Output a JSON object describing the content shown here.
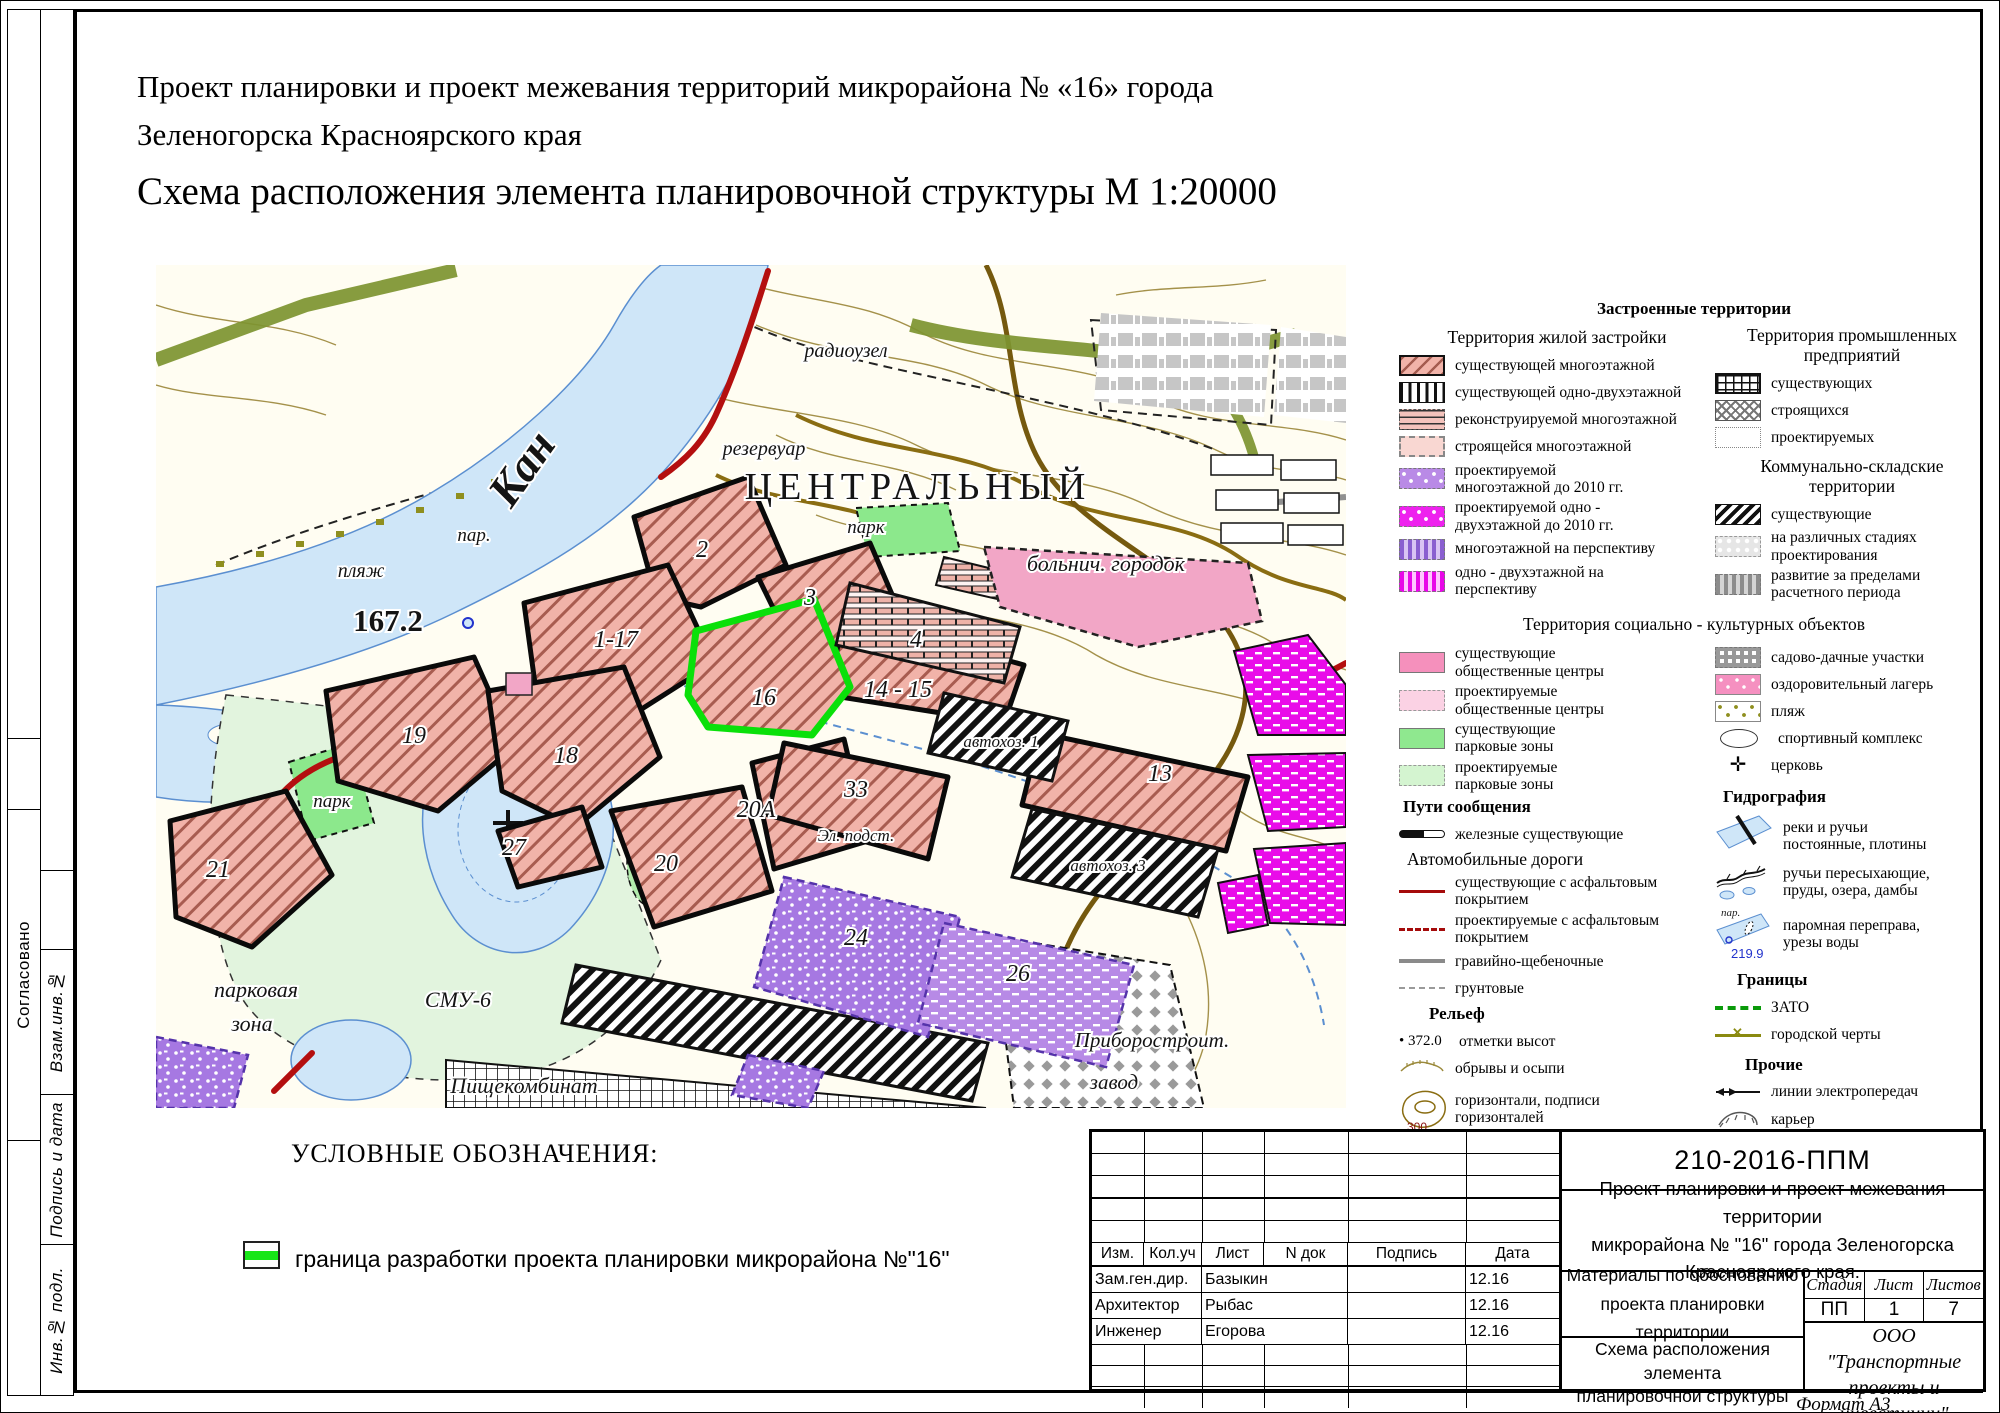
{
  "titles": {
    "line1": "Проект планировки и проект межевания территорий микрорайона № «16» города",
    "line2": "Зеленогорска Красноярского края",
    "line3": "Схема расположения элемента планировочной структуры М 1:20000"
  },
  "sidebar": {
    "soglasovano": "Согласовано",
    "vzam": "Взам.инв.№",
    "podpis": "Подпись и дата",
    "inv": "Инв.№ подл."
  },
  "map": {
    "labels": {
      "kan": "Кан",
      "elevation": "167.2",
      "plyazh": "пляж",
      "par": "пар.",
      "radiouzel": "радиоузел",
      "rezervuar": "резервуар",
      "central": "ЦЕНТРАЛЬНЫЙ",
      "park_top": "парк",
      "bolnich": "больнич. городок",
      "b2": "2",
      "b3": "3",
      "b4": "4",
      "b117": "1-17",
      "b16": "16",
      "b1415": "14 - 15",
      "b19": "19",
      "b18": "18",
      "b27": "27",
      "b20": "20",
      "b20a": "20А",
      "b33": "33",
      "b13": "13",
      "b21": "21",
      "b24": "24",
      "b26": "26",
      "elpodst": "Эл. подст.",
      "avtohoz1": "автохоз. 1",
      "avtohoz3": "автохоз. 3",
      "park_left": "парк",
      "parkovaya1": "парковая",
      "parkovaya2": "зона",
      "smu": "СМУ-6",
      "pishche": "Пищекомбинат",
      "pribor1": "Приборостроит.",
      "pribor2": "завод"
    },
    "colors": {
      "residential_pink": "#f1b3a9",
      "project_border_green": "#0ae00a",
      "road_red": "#b40f0f",
      "river_blue": "#cfe6f8",
      "park_green": "#8ce88c",
      "magenta": "#e90ce9",
      "purple": "#a678e2",
      "contour_olive": "#a4914a"
    }
  },
  "legend": {
    "built_header": "Застроенные  территории",
    "residential_title": "Территория жилой застройки",
    "residential": [
      "существующей многоэтажной",
      "существующей одно-двухэтажной",
      "реконструируемой многоэтажной",
      "строящейся многоэтажной",
      "проектируемой многоэтажной до 2010 гг.",
      "проектируемой одно - двухэтажной до 2010 гг.",
      "многоэтажной на перспективу",
      "одно - двухэтажной на перспективу"
    ],
    "industrial_title": "Территория промышленных предприятий",
    "industrial": [
      "существующих",
      "строящихся",
      "проектируемых"
    ],
    "communal_title": "Коммунально-складские территории",
    "communal": [
      "существующие",
      "на различных стадиях проектирования",
      "развитие за пределами расчетного периода"
    ],
    "social_header": "Территория социально - культурных объектов",
    "social_left": [
      "существующие общественные центры",
      "проектируемые общественные центры",
      "существующие парковые зоны",
      "проектируемые парковые зоны"
    ],
    "social_right": [
      "садово-дачные участки",
      "оздоровительный лагерь",
      "пляж",
      "спортивный комплекс",
      "церковь"
    ],
    "transport_header": "Пути сообщения",
    "railway_label": "железные существующие",
    "roads_title": "Автомобильные дороги",
    "roads": [
      "существующие с асфальтовым покрытием",
      "проектируемые с асфальтовым покрытием",
      "гравийно-щебеночные",
      "грунтовые"
    ],
    "relief_header": "Рельеф",
    "spot_value": "372.0",
    "relief": [
      "отметки высот",
      "обрывы и осыпи",
      "горизонтали, подписи горизонталей"
    ],
    "contour_value": "300",
    "hydro_header": "Гидрография",
    "hydro": [
      "реки и ручьи постоянные, плотины",
      "ручьи пересыхающие, пруды, озера, дамбы",
      "паромная переправа, урезы воды"
    ],
    "ferry_label": "пар.",
    "water_level": "219.9",
    "borders_header": "Границы",
    "borders": [
      "ЗАТО",
      "городской черты"
    ],
    "other_header": "Прочие",
    "other": [
      "линии электропередач",
      "карьер"
    ]
  },
  "conditional": {
    "header": "УСЛОВНЫЕ ОБОЗНАЧЕНИЯ:",
    "border_label": "граница разработки проекта планировки микрорайона №\"16\""
  },
  "stamp": {
    "doc_number": "210-2016-ППМ",
    "project_name1": "Проект планировки и проект межевания территории",
    "project_name2": "микрорайона № \"16\" города Зеленогорска Красноярского края.",
    "materials1": "Материалы по обоснованию",
    "materials2": "проекта планировки территории",
    "scheme1": "Схема расположения элемента",
    "scheme2": "планировочной структуры",
    "scheme3": "М 1:20000",
    "company1": "ООО \"Транспортные",
    "company2": "проекты и инвестиции\"",
    "cols": [
      "Изм.",
      "Кол.уч",
      "Лист",
      "N док",
      "Подпись",
      "Дата"
    ],
    "signers": [
      {
        "role": "Зам.ген.дир.",
        "name": "Базыкин",
        "date": "12.16"
      },
      {
        "role": "Архитектор",
        "name": "Рыбас",
        "date": "12.16"
      },
      {
        "role": "Инженер",
        "name": "Егорова",
        "date": "12.16"
      }
    ],
    "stage_label": "Стадия",
    "sheet_label": "Лист",
    "sheets_label": "Листов",
    "stage": "ПП",
    "sheet": "1",
    "sheets": "7"
  },
  "format_label": "Формат А3"
}
